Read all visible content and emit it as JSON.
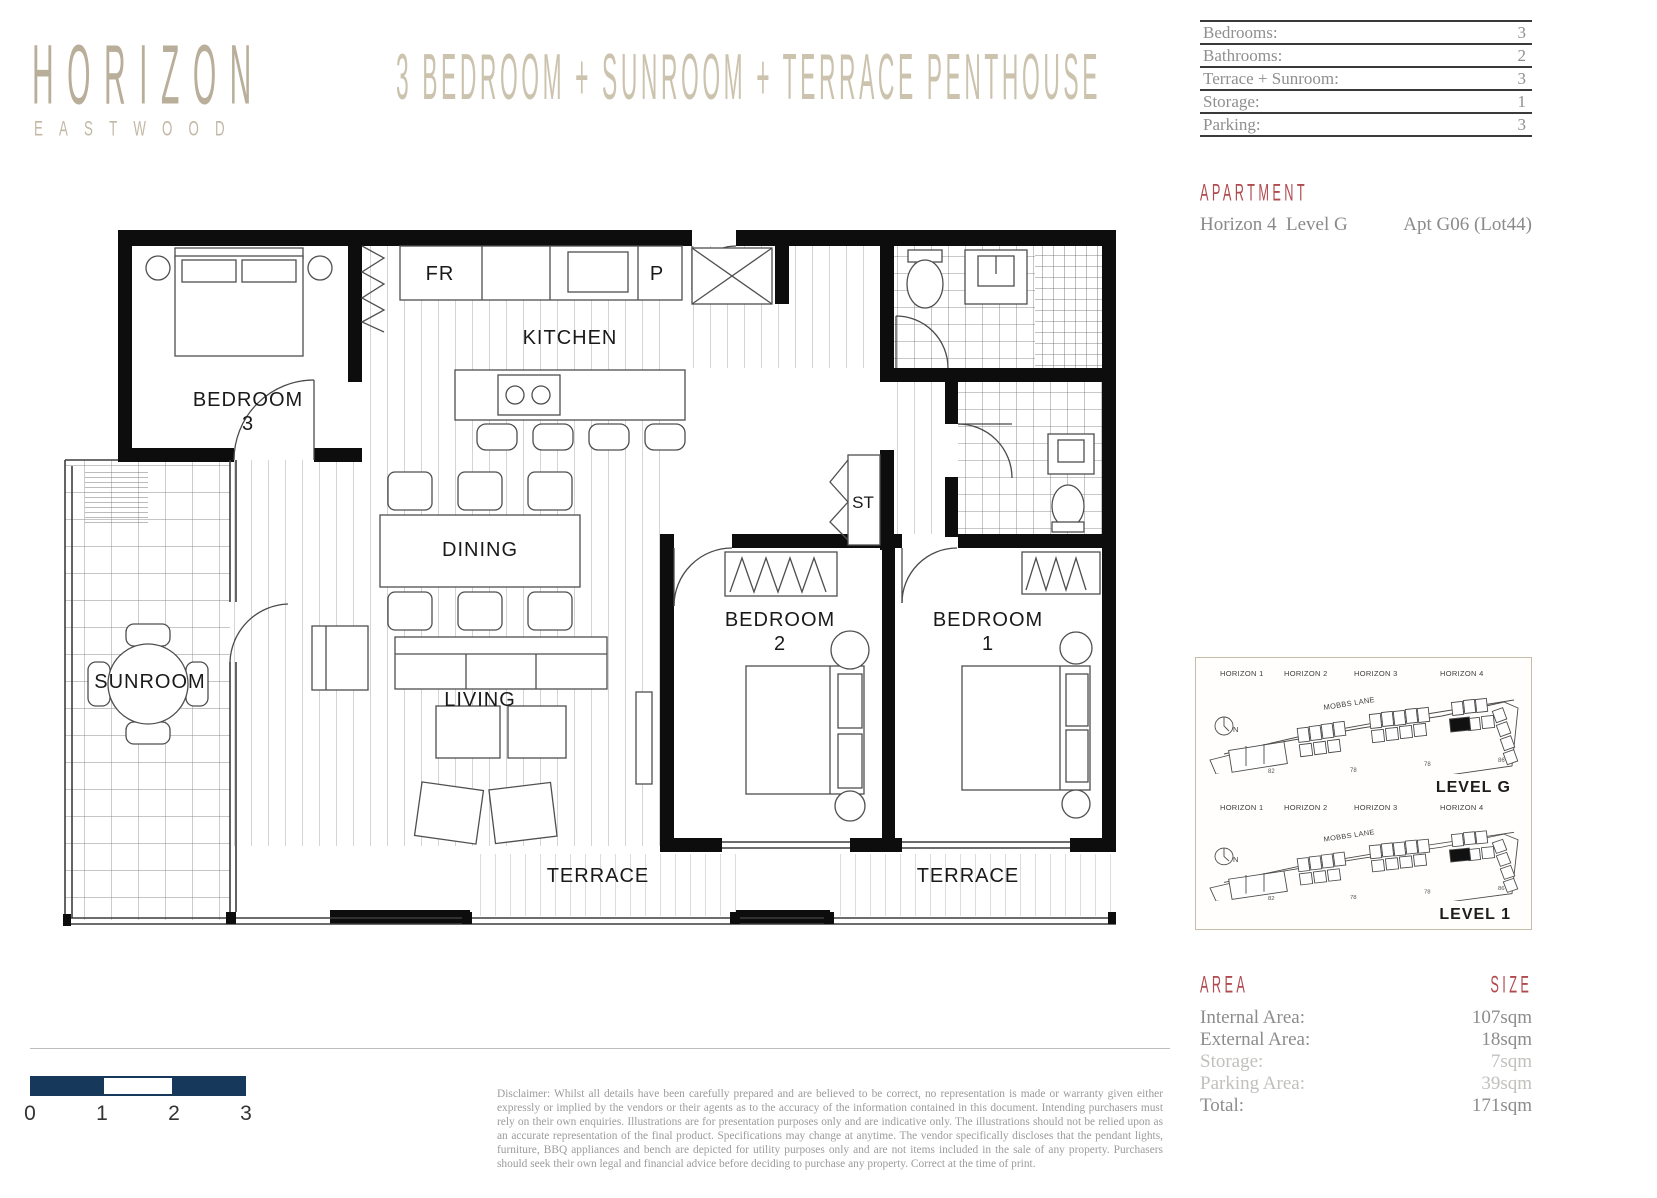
{
  "brand": {
    "name": "HORIZON",
    "subtitle": "EASTWOOD"
  },
  "page_title": "3 BEDROOM + SUNROOM + TERRACE PENTHOUSE",
  "summary_table": {
    "rows": [
      {
        "label": "Bedrooms:",
        "value": "3"
      },
      {
        "label": "Bathrooms:",
        "value": "2"
      },
      {
        "label": "Terrace + Sunroom:",
        "value": "3"
      },
      {
        "label": "Storage:",
        "value": "1"
      },
      {
        "label": "Parking:",
        "value": "3"
      }
    ]
  },
  "apartment": {
    "heading": "APARTMENT",
    "location": "Horizon 4  Level G",
    "unit": "Apt G06 (Lot44)"
  },
  "floor_plan": {
    "labels": {
      "bedroom3_line1": "BEDROOM",
      "bedroom3_line2": "3",
      "kitchen": "KITCHEN",
      "fridge": "FR",
      "pantry": "P",
      "dining": "DINING",
      "living": "LIVING",
      "sunroom": "SUNROOM",
      "storage": "ST",
      "bedroom2_line1": "BEDROOM",
      "bedroom2_line2": "2",
      "bedroom1_line1": "BEDROOM",
      "bedroom1_line2": "1",
      "terrace_center": "TERRACE",
      "terrace_right": "TERRACE"
    }
  },
  "site_maps": {
    "north": "N",
    "levels": [
      {
        "label": "LEVEL G",
        "street": "MOBBS LANE",
        "buildings": [
          "HORIZON 1",
          "HORIZON 2",
          "HORIZON 3",
          "HORIZON 4"
        ],
        "lot_numbers": [
          "82",
          "78",
          "78",
          "86"
        ]
      },
      {
        "label": "LEVEL 1",
        "street": "MOBBS LANE",
        "buildings": [
          "HORIZON 1",
          "HORIZON 2",
          "HORIZON 3",
          "HORIZON 4"
        ],
        "lot_numbers": [
          "82",
          "78",
          "78",
          "86"
        ]
      }
    ]
  },
  "area_table": {
    "heading_left": "AREA",
    "heading_right": "SIZE",
    "rows": [
      {
        "label": "Internal Area:",
        "value": "107sqm"
      },
      {
        "label": "External Area:",
        "value": "18sqm"
      },
      {
        "label": "Storage:",
        "value": "7sqm"
      },
      {
        "label": "Parking Area:",
        "value": "39sqm"
      },
      {
        "label": "Total:",
        "value": "171sqm"
      }
    ]
  },
  "scale_bar": {
    "labels": [
      "0",
      "1",
      "2",
      "3"
    ]
  },
  "disclaimer": "Disclaimer: Whilst all details have been carefully prepared and are believed to be correct, no representation is made or warranty given either expressly or implied by the vendors or their agents as to the accuracy of the information contained in this document. Intending purchasers must rely on their own enquiries. Illustrations are for presentation purposes only and are indicative only. The illustrations should not be relied upon as an accurate representation of the final product. Specifications may change at anytime. The vendor specifically discloses that the pendant lights, furniture, BBQ appliances and bench are depicted for utility purposes only and are not items included in the sale of any property. Purchasers should seek their own legal and financial advice before deciding to purchase any property. Correct at the time of print.",
  "colors": {
    "brand_beige": "#b9ae9a",
    "accent_red": "#b14a4e",
    "scale_navy": "#16395b"
  }
}
